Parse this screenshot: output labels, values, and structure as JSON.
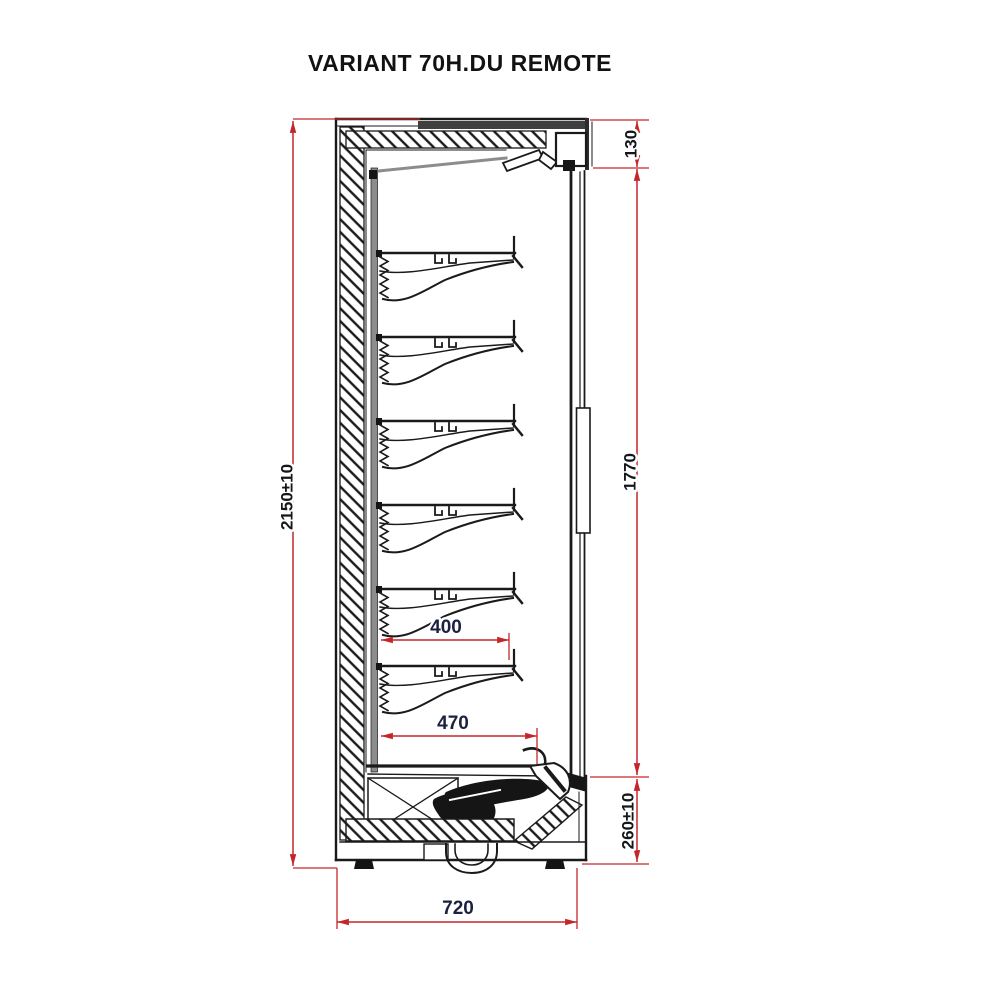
{
  "title": "VARIANT 70H.DU REMOTE",
  "dimensions": {
    "overall_height": "2150±10",
    "canopy_height": "130",
    "door_opening_height": "1770",
    "base_height": "260±10",
    "overall_depth": "720",
    "upper_shelf_depth": "400",
    "bottom_shelf_depth": "470"
  },
  "shelf_count": 6,
  "colors": {
    "background": "#ffffff",
    "line": "#1a1a1a",
    "dimension_line": "#c4272b",
    "dimension_text": "#14161a",
    "depth_text": "#1b2140",
    "liner_gray": "#8c8c8c"
  }
}
